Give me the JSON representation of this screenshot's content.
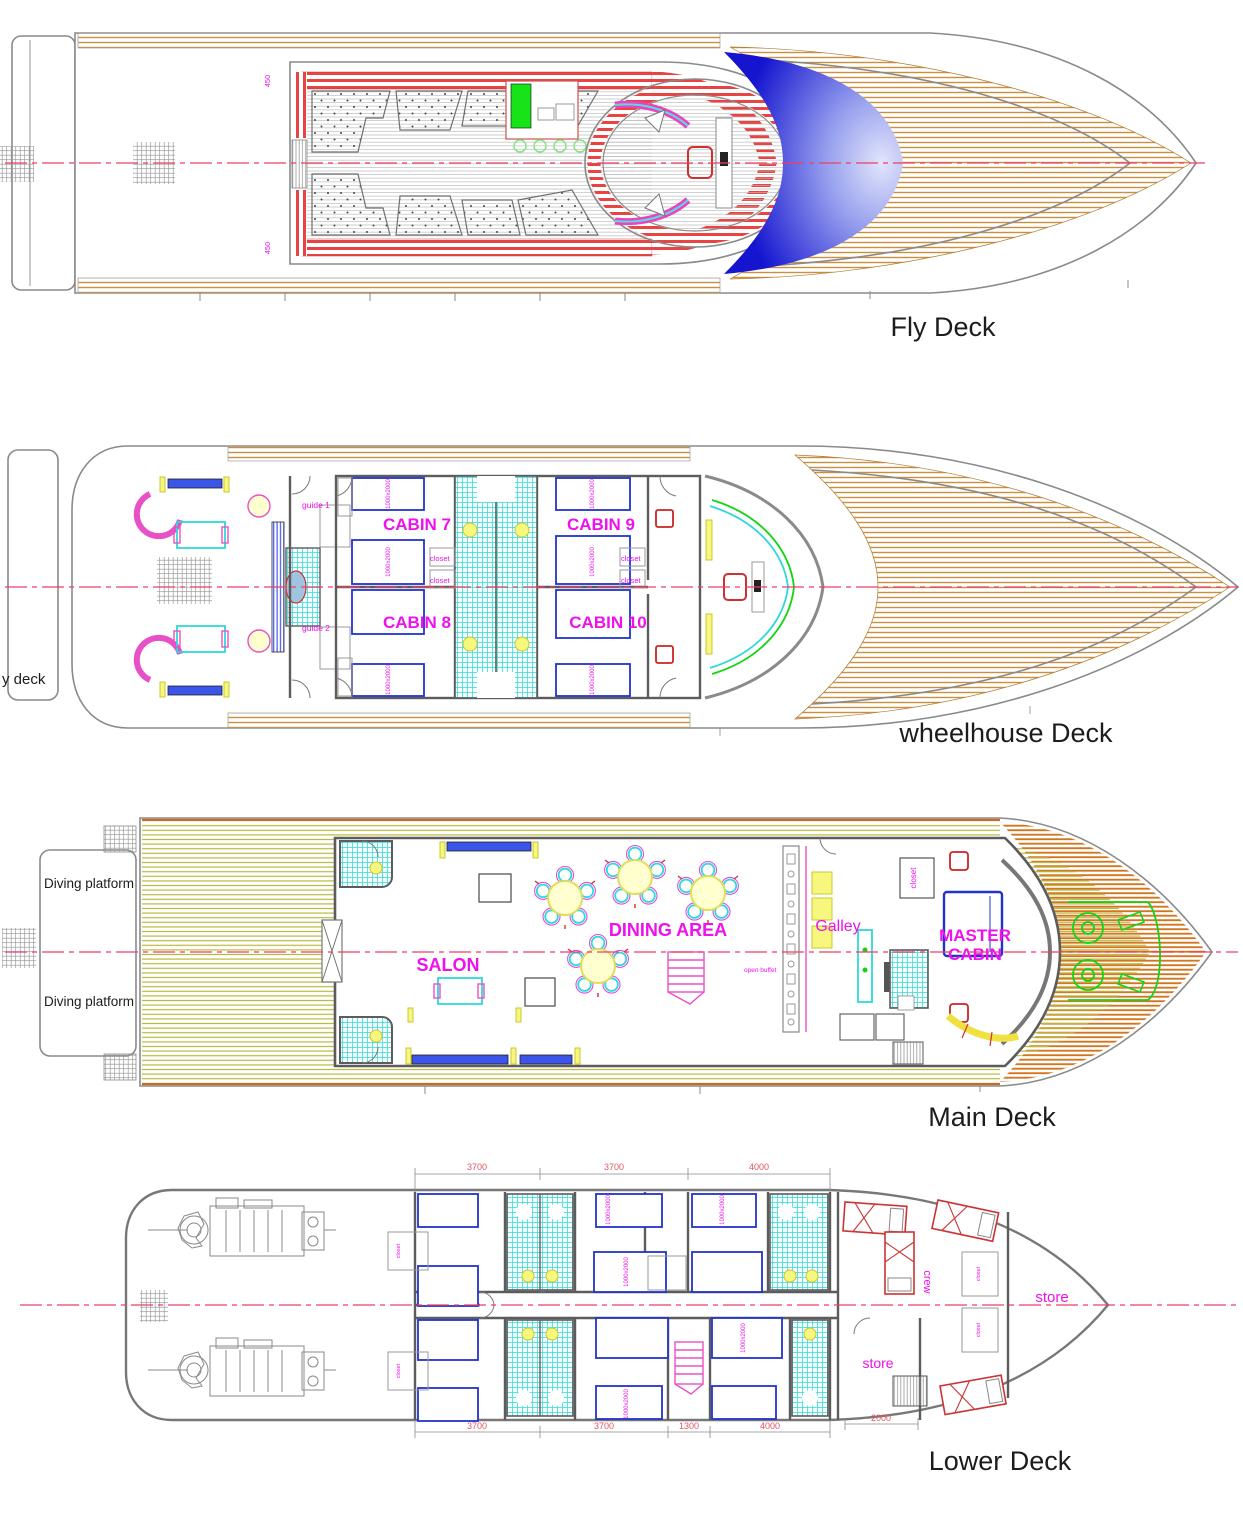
{
  "colors": {
    "magenta": "#ee10ee",
    "deck_label": "#1c1c1c",
    "wood": "#c9913f",
    "olive": "#b9b83f",
    "orange_bow": "#d2771f",
    "red_stripe": "#e84444",
    "windshield_blue": "#1515cf",
    "centerline": "#ef3e66",
    "bed_blue": "#2233cc",
    "tile_cyan": "#3fd9d9",
    "dim_red": "#e05560",
    "green": "#12d412"
  },
  "decks": {
    "fly": {
      "title": "Fly Deck",
      "dim_450": "450"
    },
    "wheelhouse": {
      "title": "wheelhouse Deck",
      "edge_label": "y deck",
      "cabin7": "CABIN 7",
      "cabin8": "CABIN 8",
      "cabin9": "CABIN 9",
      "cabin10": "CABIN 10",
      "guide1": "guide 1",
      "guide2": "guide 2",
      "closet": "closet",
      "bed_size": "1000x2000"
    },
    "main": {
      "title": "Main Deck",
      "diving_platform": "Diving platform",
      "salon": "SALON",
      "dining_area": "DINING AREA",
      "galley": "Galley",
      "closet": "closet",
      "open_buffet": "open buffet",
      "master_line1": "MASTER",
      "master_line2": "CABIN"
    },
    "lower": {
      "title": "Lower Deck",
      "cabins": [
        "CABIN 1",
        "CABIN 2",
        "CABIN 3",
        "CABIN 4",
        "CABIN 5",
        "CABIN 6"
      ],
      "crew": "crew",
      "store_aft": "store",
      "store_bow": "store",
      "closet": "closet",
      "bed_size": "1000x2000",
      "dims_top": [
        "3700",
        "3700",
        "4000"
      ],
      "dims_bottom": [
        "3700",
        "3700",
        "1300",
        "4000"
      ],
      "dim_bow": "2000"
    }
  }
}
